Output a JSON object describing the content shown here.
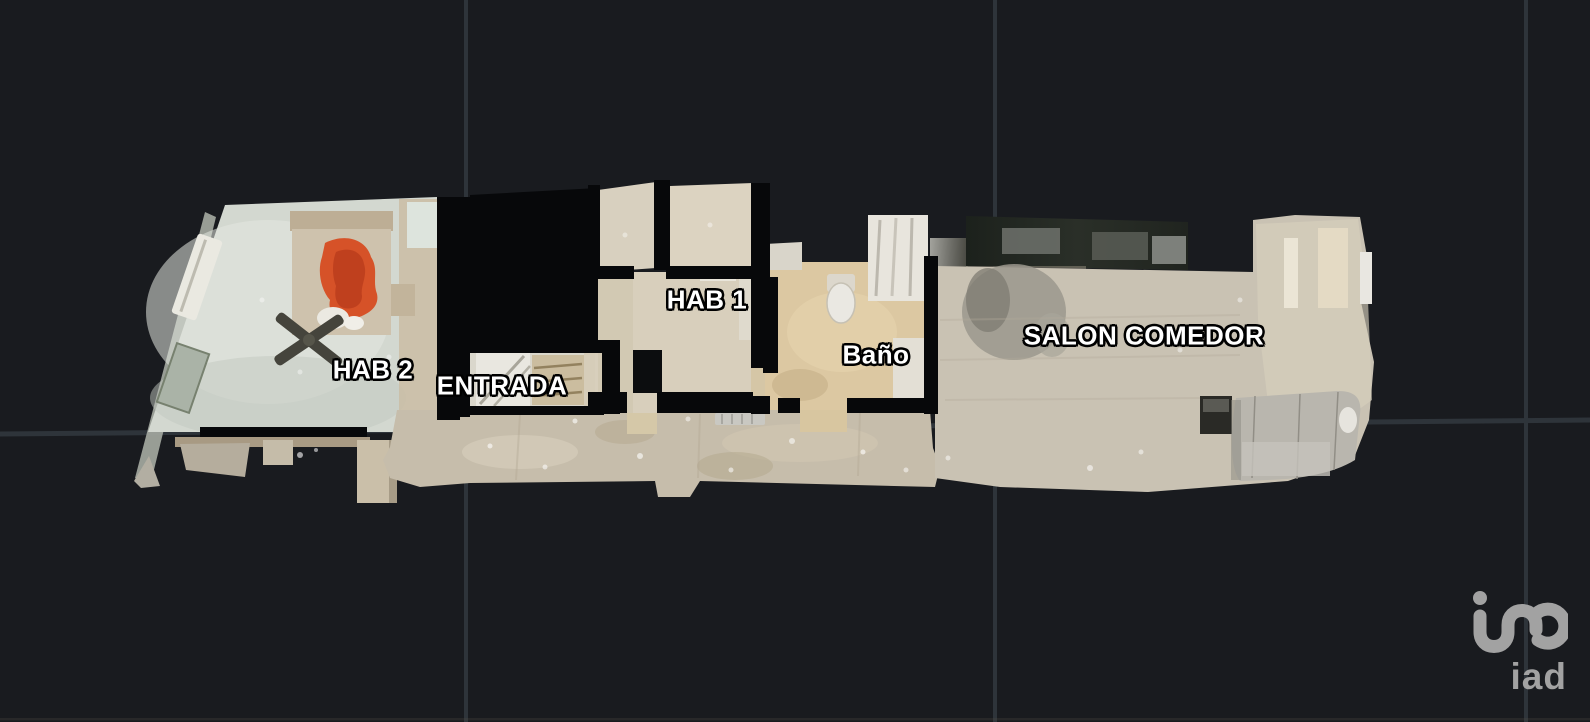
{
  "view": {
    "background": "#191b1f",
    "grid_color": "#2e343a",
    "label_color": "#ffffff",
    "label_outline": "#000000"
  },
  "rooms": {
    "hab2": "HAB 2",
    "entrada": "ENTRADA",
    "hab1": "HAB 1",
    "bano": "Baño",
    "salon": "SALON COMEDOR"
  },
  "branding": {
    "logo_text": "iad",
    "logo_color": "#a2a2a2"
  }
}
